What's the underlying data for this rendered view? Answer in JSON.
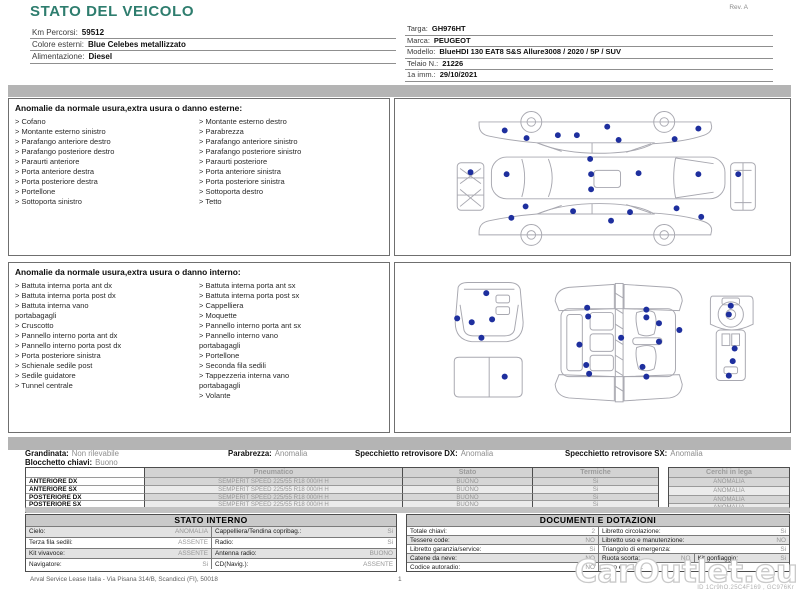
{
  "page": {
    "title": "STATO DEL VEICOLO",
    "revision": "Rev. A"
  },
  "bullet": ">",
  "colors": {
    "accent": "#2E7D6E",
    "marker": "#1E2F9E",
    "separator_bar": "#B4B4B4"
  },
  "header": {
    "left_fields": [
      {
        "label": "Km Percorsi:",
        "value": "59512"
      },
      {
        "label": "Colore esterni:",
        "value": "Blue Celebes metallizzato"
      },
      {
        "label": "Alimentazione:",
        "value": "Diesel"
      }
    ],
    "right_fields": [
      {
        "label": "Targa:",
        "value": "GH976HT"
      },
      {
        "label": "Marca:",
        "value": "PEUGEOT"
      },
      {
        "label": "Modello:",
        "value": "BlueHDI 130 EAT8 S&S Allure3008 / 2020 / 5P / SUV"
      },
      {
        "label": "Telaio N.:",
        "value": "21226"
      },
      {
        "label": "1a imm.:",
        "value": "29/10/2021"
      }
    ]
  },
  "sections": {
    "external": {
      "title": "Anomalie da normale usura,extra usura o danno esterne:",
      "columns": [
        [
          "Cofano",
          "Montante esterno sinistro",
          "Parafango anteriore destro",
          "Parafango posteriore destro",
          "Paraurti anteriore",
          "Porta anteriore destra",
          "Porta posteriore destra",
          "Portellone",
          "Sottoporta sinistro"
        ],
        [
          "Montante esterno destro",
          "Parabrezza",
          "Parafango anteriore sinistro",
          "Parafango posteriore sinistro",
          "Paraurti posteriore",
          "Porta anteriore sinistra",
          "Porta posteriore sinistra",
          "Sottoporta destro",
          "Tetto"
        ]
      ]
    },
    "internal": {
      "title": "Anomalie da normale usura,extra usura o danno interno:",
      "columns": [
        [
          "Battuta interna porta ant dx",
          "Battuta interna porta post dx",
          "Battuta interna vano\nportabagagli",
          "Cruscotto",
          "Pannello interno porta ant dx",
          "Pannello interno porta post dx",
          "Porta posteriore sinistra",
          "Schienale sedile post",
          "Sedile guidatore",
          "Tunnel centrale"
        ],
        [
          "Battuta interna porta ant sx",
          "Battuta interna porta post sx",
          "Cappelliera",
          "Moquette",
          "Pannello interno porta ant sx",
          "Pannello interno vano\nportabagagli",
          "Portellone",
          "Seconda fila sedili",
          "Tappezzeria interna vano\nportabagagli",
          "Volante"
        ]
      ]
    }
  },
  "summary": {
    "line1": [
      {
        "label": "Grandinata:",
        "value": "Non rilevabile"
      },
      {
        "label": "Parabrezza:",
        "value": "Anomalia"
      },
      {
        "label": "Specchietto retrovisore DX:",
        "value": "Anomalia"
      },
      {
        "label": "Specchietto retrovisore SX:",
        "value": "Anomalia"
      }
    ],
    "line2": [
      {
        "label": "Blocchetto chiavi:",
        "value": "Buono"
      }
    ]
  },
  "tyres": {
    "headers": {
      "pneumatico": "Pneumatico",
      "stato": "Stato",
      "termiche": "Termiche",
      "cerchi": "Cerchi in lega"
    },
    "rows": [
      {
        "pos": "ANTERIORE DX",
        "tyre": "SEMPERIT SPEED 225/55 R18 000/H H",
        "stato": "BUONO",
        "termiche": "Si",
        "cerchi": "ANOMALIA"
      },
      {
        "pos": "ANTERIORE SX",
        "tyre": "SEMPERIT SPEED 225/55 R18 000/H H",
        "stato": "BUONO",
        "termiche": "Si",
        "cerchi": "ANOMALIA"
      },
      {
        "pos": "POSTERIORE DX",
        "tyre": "SEMPERIT SPEED 225/55 R18 000/H H",
        "stato": "BUONO",
        "termiche": "Si",
        "cerchi": "ANOMALIA"
      },
      {
        "pos": "POSTERIORE SX",
        "tyre": "SEMPERIT SPEED 225/55 R18 000/H H",
        "stato": "BUONO",
        "termiche": "Si",
        "cerchi": "ANOMALIA"
      }
    ]
  },
  "stato_interno": {
    "title": "STATO INTERNO",
    "rows": [
      [
        {
          "label": "Cielo:",
          "value": "ANOMALIA"
        },
        {
          "label": "Cappelliera/Tendina copribag.:",
          "value": "Si"
        }
      ],
      [
        {
          "label": "Terza fila sedili:",
          "value": "ASSENTE"
        },
        {
          "label": "Radio:",
          "value": "Si"
        }
      ],
      [
        {
          "label": "Kit vivavoce:",
          "value": "ASSENTE"
        },
        {
          "label": "Antenna radio:",
          "value": "BUONO"
        }
      ],
      [
        {
          "label": "Navigatore:",
          "value": "Si"
        },
        {
          "label": "CD(Navig.):",
          "value": "ASSENTE"
        }
      ]
    ]
  },
  "documenti": {
    "title": "DOCUMENTI E DOTAZIONI",
    "rows": [
      [
        {
          "label": "Totale chiavi:",
          "value": "2"
        },
        {
          "label": "Libretto circolazione:",
          "value": "Si"
        }
      ],
      [
        {
          "label": "Tessere code:",
          "value": "NO"
        },
        {
          "label": "Libretto uso e manutenzione:",
          "value": "NO"
        }
      ],
      [
        {
          "label": "Libretto garanzia/service:",
          "value": "Si"
        },
        {
          "label": "Triangolo di emergenza:",
          "value": "Si"
        }
      ],
      [
        {
          "label": "Catene da neve:",
          "value": "NO"
        },
        {
          "label": "Ruota scorta:",
          "value": "NO"
        },
        {
          "label": "Kit gonfiaggio:",
          "value": "Si"
        }
      ],
      [
        {
          "label": "Codice autoradio:",
          "value": "NO"
        },
        {
          "label": "Cavo elettrico:",
          "value": ""
        }
      ]
    ]
  },
  "footer": {
    "company": "Arval Service Lease Italia - Via Pisana 314/B, Scandicci (FI), 50018",
    "page_number": "1",
    "watermark": "CarOutlet.eu",
    "watermark_id": "ID 1Cr9hO.25C4F169 , GC976Kr"
  },
  "diagrams": {
    "exterior": {
      "dots": [
        [
          102,
          30
        ],
        [
          125,
          38
        ],
        [
          158,
          35
        ],
        [
          178,
          35
        ],
        [
          210,
          26
        ],
        [
          222,
          40
        ],
        [
          281,
          39
        ],
        [
          306,
          28
        ],
        [
          66,
          74
        ],
        [
          104,
          76
        ],
        [
          192,
          60
        ],
        [
          193,
          76
        ],
        [
          193,
          92
        ],
        [
          243,
          75
        ],
        [
          306,
          76
        ],
        [
          348,
          76
        ],
        [
          124,
          110
        ],
        [
          109,
          122
        ],
        [
          174,
          115
        ],
        [
          214,
          125
        ],
        [
          234,
          116
        ],
        [
          283,
          112
        ],
        [
          309,
          121
        ]
      ]
    },
    "interior": {
      "dots": [
        [
          85,
          28
        ],
        [
          55,
          54
        ],
        [
          70,
          58
        ],
        [
          91,
          55
        ],
        [
          80,
          74
        ],
        [
          104,
          114
        ],
        [
          189,
          43
        ],
        [
          250,
          45
        ],
        [
          190,
          52
        ],
        [
          250,
          53
        ],
        [
          263,
          59
        ],
        [
          284,
          66
        ],
        [
          224,
          74
        ],
        [
          181,
          81
        ],
        [
          263,
          78
        ],
        [
          188,
          102
        ],
        [
          246,
          104
        ],
        [
          191,
          111
        ],
        [
          250,
          114
        ],
        [
          337,
          41
        ],
        [
          335,
          50
        ],
        [
          341,
          85
        ],
        [
          339,
          98
        ],
        [
          335,
          113
        ]
      ]
    }
  }
}
